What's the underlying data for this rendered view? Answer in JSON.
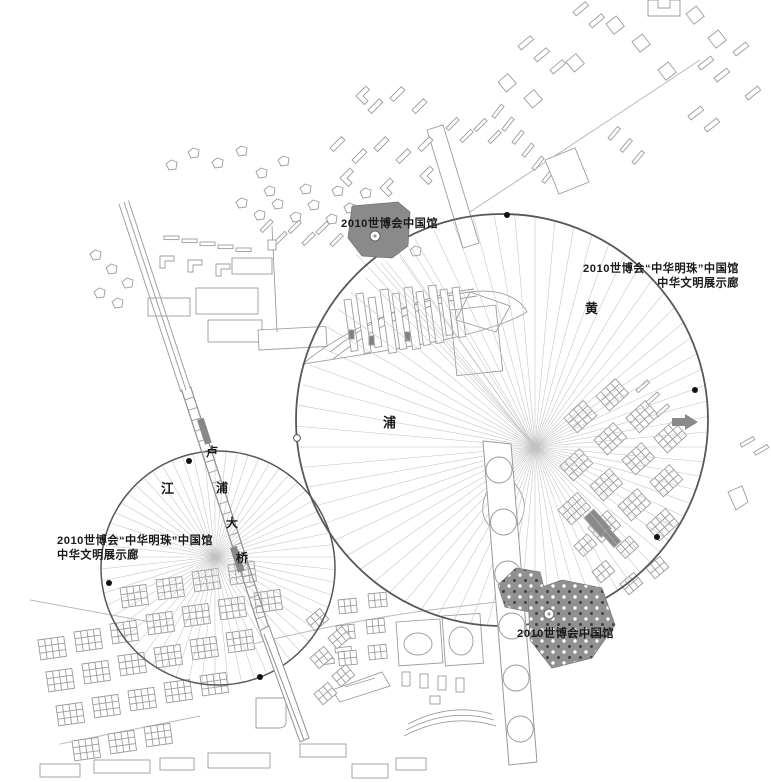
{
  "labels": {
    "top_pavilion": "2010世博会中国馆",
    "bottom_pavilion": "2010世博会中国馆",
    "right_gallery_line1": "2010世博会“中华明珠”中国馆",
    "right_gallery_line2": "中华文明展示廊",
    "left_gallery_line1": "2010世博会“中华明珠”中国馆",
    "left_gallery_line2": "中华文明展示廊"
  },
  "river": {
    "name": "黄浦江",
    "chars": [
      "黄",
      "浦",
      "江"
    ]
  },
  "bridge": {
    "name": "卢浦大桥",
    "chars": [
      "卢",
      "浦",
      "大",
      "桥"
    ]
  },
  "figure": {
    "colors": {
      "ink": "#575757",
      "fan": "#c2c2c2",
      "building": "#9c9c9c",
      "dark": "#8a8a8a"
    },
    "circles": [
      {
        "cx": 502,
        "cy": 420,
        "r": 206,
        "width": 1.8
      },
      {
        "cx": 218,
        "cy": 568,
        "r": 117,
        "width": 1.5
      }
    ],
    "fans": [
      {
        "cx": 535,
        "cy": 447,
        "len": 240,
        "step": 5,
        "clip": 0
      },
      {
        "cx": 215,
        "cy": 557,
        "len": 140,
        "step": 6,
        "clip": 1
      }
    ],
    "extra_rays": [
      [
        535,
        447,
        356,
        254
      ],
      [
        535,
        447,
        370,
        258
      ],
      [
        535,
        447,
        385,
        260
      ],
      [
        535,
        447,
        400,
        257
      ],
      [
        535,
        447,
        411,
        248
      ]
    ],
    "markers": [
      {
        "x": 507,
        "y": 215,
        "type": "dot"
      },
      {
        "x": 695,
        "y": 390,
        "type": "dot"
      },
      {
        "x": 657,
        "y": 537,
        "type": "dot"
      },
      {
        "x": 297,
        "y": 438,
        "type": "ring"
      },
      {
        "x": 189,
        "y": 461,
        "type": "dot"
      },
      {
        "x": 109,
        "y": 583,
        "type": "dot"
      },
      {
        "x": 260,
        "y": 677,
        "type": "dot"
      },
      {
        "x": 375,
        "y": 236,
        "type": "pav"
      },
      {
        "x": 549,
        "y": 614,
        "type": "pav"
      }
    ],
    "ladder": {
      "x1": 186,
      "y1": 388,
      "x2": 264,
      "y2": 628,
      "halfw": 4.8,
      "rungs": 22
    }
  }
}
